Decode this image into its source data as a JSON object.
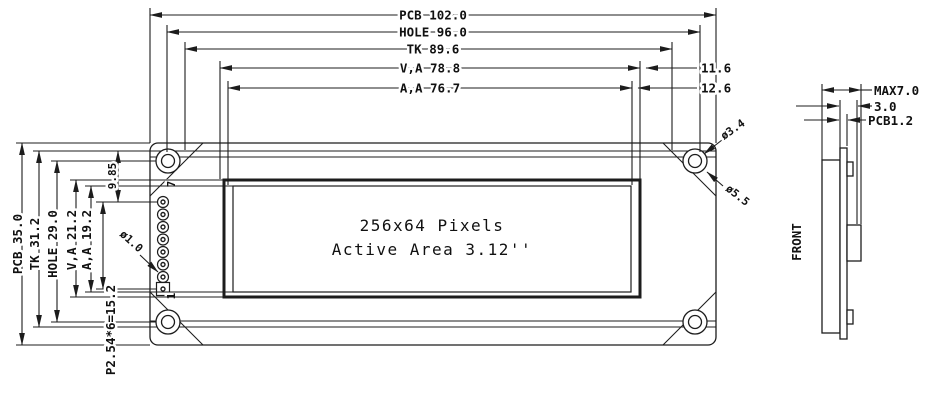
{
  "front_view": {
    "display": {
      "line1": "256x64 Pixels",
      "line2": "Active Area 3.12''"
    },
    "horizontal_dims": {
      "pcb": "PCB 102.0",
      "hole": "HOLE 96.0",
      "tk": "TK 89.6",
      "va": "V,A 78.8",
      "aa": "A,A 76.7",
      "va_right_margin": "11.6",
      "aa_right_margin": "12.6"
    },
    "vertical_dims": {
      "pcb": "PCB 35.0",
      "tk": "TK 31.2",
      "hole": "HOLE 29.0",
      "va": "V,A 21.2",
      "aa": "A,A 19.2",
      "pin_offset": "9.85",
      "pin_pitch": "P2.54*6=15.2"
    },
    "callouts": {
      "mount_hole_inner": "ø3.4",
      "mount_hole_pad": "ø5.5",
      "pin_hole": "ø1.0"
    },
    "pins": {
      "first": "7",
      "last": "1"
    }
  },
  "side_view": {
    "dims": {
      "max_depth": "MAX7.0",
      "module_depth": "3.0",
      "pcb_thickness": "PCB1.2"
    },
    "label": "FRONT"
  },
  "colors": {
    "line": "#1c1c1c",
    "background": "#ffffff"
  }
}
